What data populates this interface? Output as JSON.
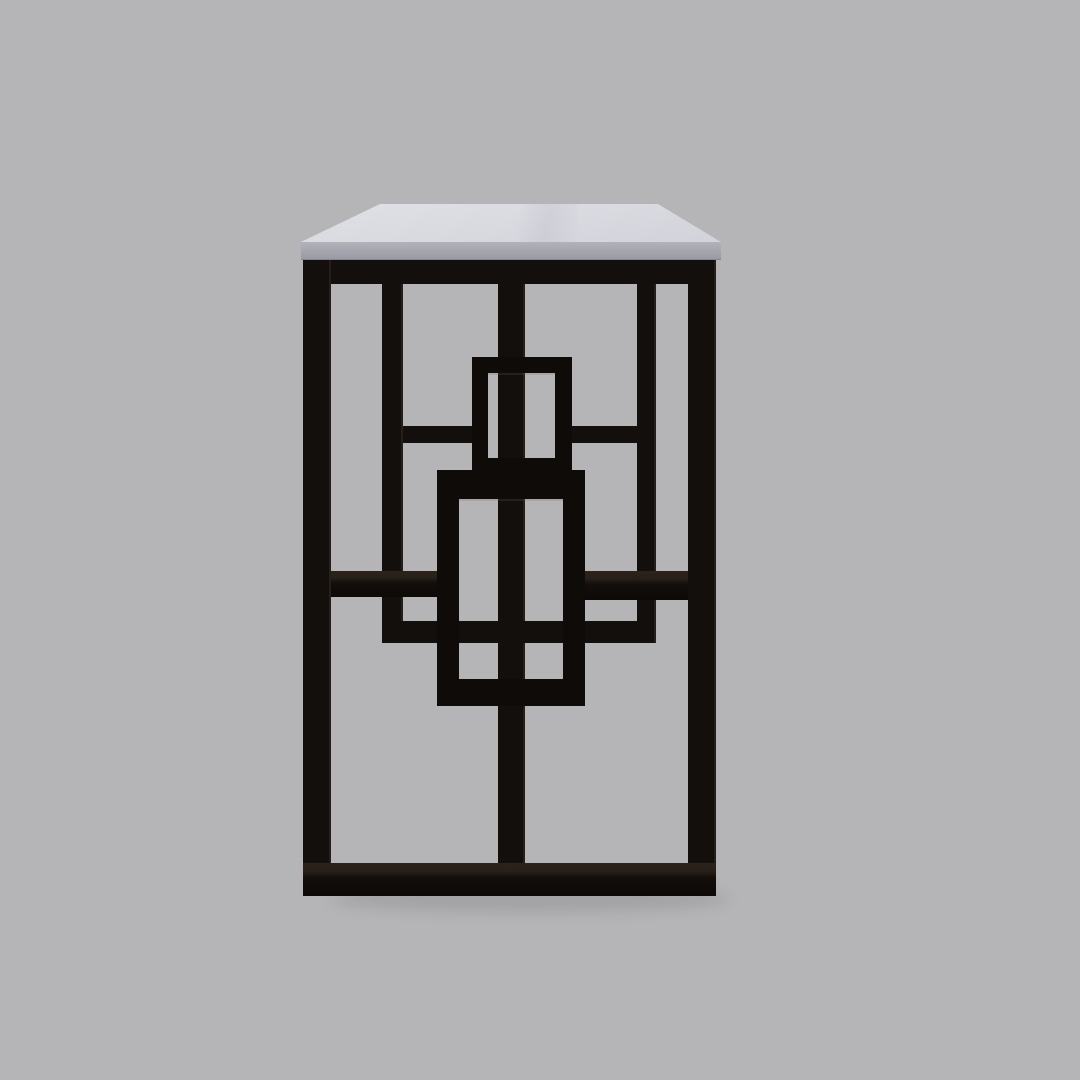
{
  "meta": {
    "description": "Product photograph of a modern console table, side view: rectangular white top on a black metal frame with a geometric lattice of rectangles",
    "object": "console-table-side-view",
    "background_color": "#b5b5b7"
  },
  "canvas": {
    "width": 1080,
    "height": 1080
  },
  "table": {
    "top": {
      "surface": {
        "name": "tabletop-surface",
        "polygon": [
          [
            380,
            204
          ],
          [
            658,
            204
          ],
          [
            721,
            242
          ],
          [
            301,
            242
          ]
        ],
        "color_light": "#e0e1e7",
        "color_dark": "#d2d3da"
      },
      "edge_band": {
        "name": "tabletop-edge",
        "x": 301,
        "y": 242,
        "w": 420,
        "h": 17,
        "color_top": "#b2b2bb",
        "color_bottom": "#9a9aa4"
      }
    },
    "frame": {
      "color": "#130f0c",
      "members": [
        {
          "name": "top-rail",
          "x": 303,
          "y": 259,
          "w": 413,
          "h": 25
        },
        {
          "name": "left-leg",
          "x": 303,
          "y": 259,
          "w": 28,
          "h": 637,
          "vert": true
        },
        {
          "name": "right-leg",
          "x": 688,
          "y": 259,
          "w": 28,
          "h": 637,
          "vert": true
        },
        {
          "name": "bottom-rail",
          "x": 303,
          "y": 863,
          "w": 413,
          "h": 33,
          "top_face": true
        },
        {
          "name": "center-post",
          "x": 498,
          "y": 284,
          "w": 27,
          "h": 579,
          "vert": true
        },
        {
          "name": "left-inner-vertical",
          "x": 382,
          "y": 284,
          "w": 21,
          "h": 359,
          "vert": true
        },
        {
          "name": "right-inner-vertical",
          "x": 637,
          "y": 284,
          "w": 19,
          "h": 359,
          "vert": true
        },
        {
          "name": "upper-left-stub",
          "x": 403,
          "y": 426,
          "w": 69,
          "h": 17
        },
        {
          "name": "upper-right-stub",
          "x": 572,
          "y": 426,
          "w": 65,
          "h": 17
        },
        {
          "name": "mid-left-rail",
          "x": 331,
          "y": 571,
          "w": 106,
          "h": 26,
          "top_face": true
        },
        {
          "name": "mid-right-rail",
          "x": 585,
          "y": 571,
          "w": 103,
          "h": 29,
          "top_face": true
        },
        {
          "name": "lower-cross-bar",
          "x": 390,
          "y": 621,
          "w": 260,
          "h": 22
        }
      ],
      "overlay_rects": [
        {
          "name": "upper-overlay-rectangle",
          "x": 472,
          "y": 357,
          "w": 100,
          "h": 117,
          "border": {
            "top": 16,
            "right": 17,
            "bottom": 16,
            "left": 16
          }
        },
        {
          "name": "lower-overlay-rectangle",
          "x": 437,
          "y": 470,
          "w": 148,
          "h": 236,
          "border": {
            "top": 29,
            "right": 22,
            "bottom": 27,
            "left": 22
          }
        }
      ]
    },
    "shadow": {
      "name": "floor-shadow",
      "x": 330,
      "y": 886,
      "w": 400,
      "h": 26
    }
  }
}
